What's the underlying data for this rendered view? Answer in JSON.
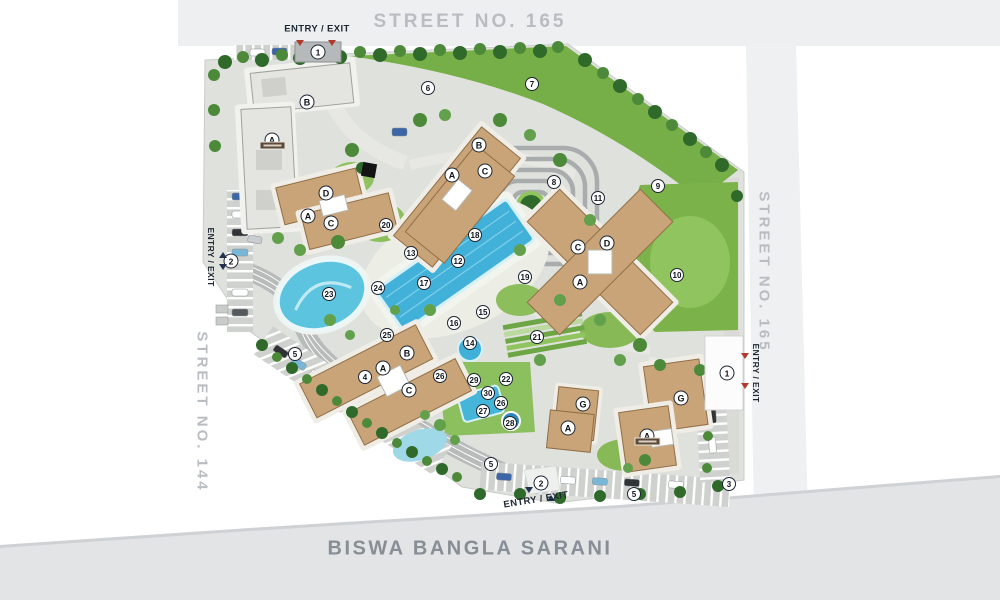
{
  "streets": {
    "top": "STREET NO. 165",
    "right": "STREET NO. 165",
    "left": "STREET NO. 144",
    "bottom": "BISWA BANGLA SARANI"
  },
  "gates": [
    {
      "id": "gate-top",
      "num": "1",
      "label": "ENTRY / EXIT",
      "cx": 318,
      "cy": 52,
      "lx": 317,
      "ly": 29,
      "orient": "h"
    },
    {
      "id": "gate-left",
      "num": "2",
      "label": "ENTRY / EXIT",
      "cx": 231,
      "cy": 261,
      "lx": 211,
      "ly": 257,
      "orient": "v"
    },
    {
      "id": "gate-right",
      "num": "1",
      "label": "ENTRY / EXIT",
      "cx": 727,
      "cy": 373,
      "lx": 756,
      "ly": 373,
      "orient": "v"
    },
    {
      "id": "gate-bottom",
      "num": "2",
      "label": "ENTRY / EXIT",
      "cx": 541,
      "cy": 483,
      "lx": 536,
      "ly": 500,
      "orient": "tilt"
    }
  ],
  "markers": [
    {
      "n": "3",
      "x": 729,
      "y": 484
    },
    {
      "n": "4",
      "x": 365,
      "y": 377
    },
    {
      "n": "5",
      "x": 295,
      "y": 354
    },
    {
      "n": "5",
      "x": 491,
      "y": 464
    },
    {
      "n": "5",
      "x": 634,
      "y": 494
    },
    {
      "n": "6",
      "x": 428,
      "y": 88
    },
    {
      "n": "7",
      "x": 532,
      "y": 84
    },
    {
      "n": "8",
      "x": 554,
      "y": 182
    },
    {
      "n": "9",
      "x": 658,
      "y": 186
    },
    {
      "n": "10",
      "x": 677,
      "y": 275
    },
    {
      "n": "11",
      "x": 598,
      "y": 198
    },
    {
      "n": "12",
      "x": 458,
      "y": 261
    },
    {
      "n": "13",
      "x": 411,
      "y": 253
    },
    {
      "n": "14",
      "x": 470,
      "y": 343
    },
    {
      "n": "15",
      "x": 483,
      "y": 312
    },
    {
      "n": "16",
      "x": 454,
      "y": 323
    },
    {
      "n": "17",
      "x": 424,
      "y": 283
    },
    {
      "n": "18",
      "x": 475,
      "y": 235
    },
    {
      "n": "19",
      "x": 525,
      "y": 277
    },
    {
      "n": "20",
      "x": 386,
      "y": 225
    },
    {
      "n": "21",
      "x": 537,
      "y": 337
    },
    {
      "n": "22",
      "x": 506,
      "y": 379
    },
    {
      "n": "23",
      "x": 329,
      "y": 294
    },
    {
      "n": "24",
      "x": 378,
      "y": 288
    },
    {
      "n": "25",
      "x": 387,
      "y": 335
    },
    {
      "n": "26",
      "x": 440,
      "y": 376
    },
    {
      "n": "26",
      "x": 501,
      "y": 403
    },
    {
      "n": "27",
      "x": 483,
      "y": 411
    },
    {
      "n": "28",
      "x": 510,
      "y": 423
    },
    {
      "n": "29",
      "x": 474,
      "y": 380
    },
    {
      "n": "30",
      "x": 488,
      "y": 393
    }
  ],
  "towers": [
    {
      "t": "B",
      "x": 307,
      "y": 102
    },
    {
      "t": "A",
      "x": 272,
      "y": 140,
      "plate": true
    },
    {
      "t": "D",
      "x": 326,
      "y": 193
    },
    {
      "t": "A",
      "x": 308,
      "y": 216
    },
    {
      "t": "C",
      "x": 331,
      "y": 223
    },
    {
      "t": "B",
      "x": 479,
      "y": 145
    },
    {
      "t": "A",
      "x": 452,
      "y": 175
    },
    {
      "t": "C",
      "x": 485,
      "y": 171
    },
    {
      "t": "C",
      "x": 578,
      "y": 247
    },
    {
      "t": "D",
      "x": 607,
      "y": 243
    },
    {
      "t": "A",
      "x": 580,
      "y": 282
    },
    {
      "t": "B",
      "x": 407,
      "y": 353
    },
    {
      "t": "A",
      "x": 383,
      "y": 368
    },
    {
      "t": "C",
      "x": 409,
      "y": 390
    },
    {
      "t": "G",
      "x": 583,
      "y": 404
    },
    {
      "t": "A",
      "x": 568,
      "y": 428
    },
    {
      "t": "G",
      "x": 681,
      "y": 398
    },
    {
      "t": "A",
      "x": 647,
      "y": 436,
      "plate": true
    }
  ],
  "colors": {
    "accent_red": "#b03a2e",
    "navy": "#22324c",
    "marker_border": "#1b2531",
    "street_text": "#b9bdc1",
    "bottom_street_text": "#878e95",
    "pool": "#41b1d9",
    "lawn": "#7cb24a",
    "building": "#c9a478",
    "road": "#dfe1dc"
  }
}
